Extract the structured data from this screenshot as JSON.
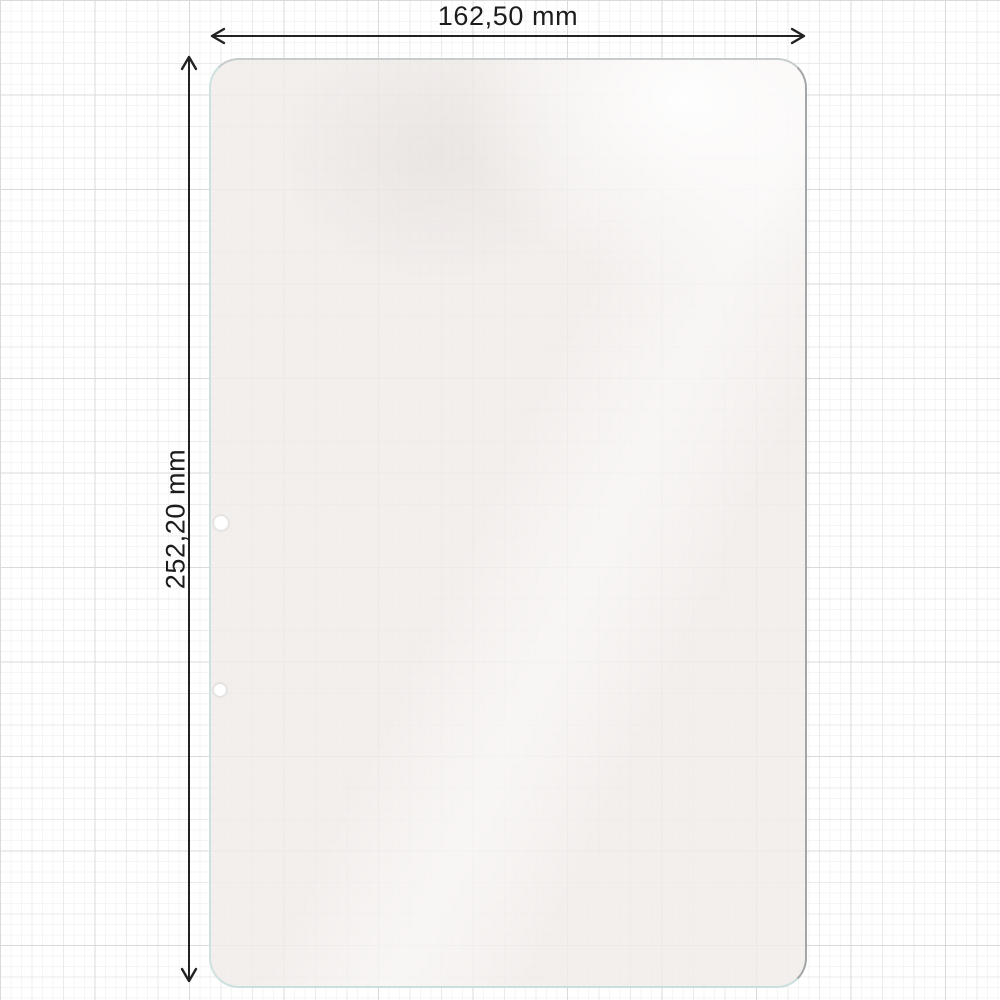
{
  "diagram": {
    "type": "product-dimension-diagram",
    "subject": "tablet-screen-protector-outline",
    "dimensions": {
      "width": {
        "label": "162,50 mm",
        "value": 162.5,
        "unit": "mm"
      },
      "height": {
        "label": "252,20 mm",
        "value": 252.2,
        "unit": "mm"
      }
    },
    "cutouts": {
      "count": 2,
      "name": "camera-hole-cutouts"
    },
    "colors": {
      "background": "#ffffff",
      "grid_major": "#d9dbdb",
      "grid_medium": "#eaebeb",
      "grid_fine": "#f5f5f5",
      "protector_fill": "#f0ece9",
      "protector_edge_teal": "#cde2e0",
      "protector_edge_shadow": "#a2a6a6",
      "dimension_line": "#222222",
      "label_text": "#1c1c1c"
    }
  }
}
